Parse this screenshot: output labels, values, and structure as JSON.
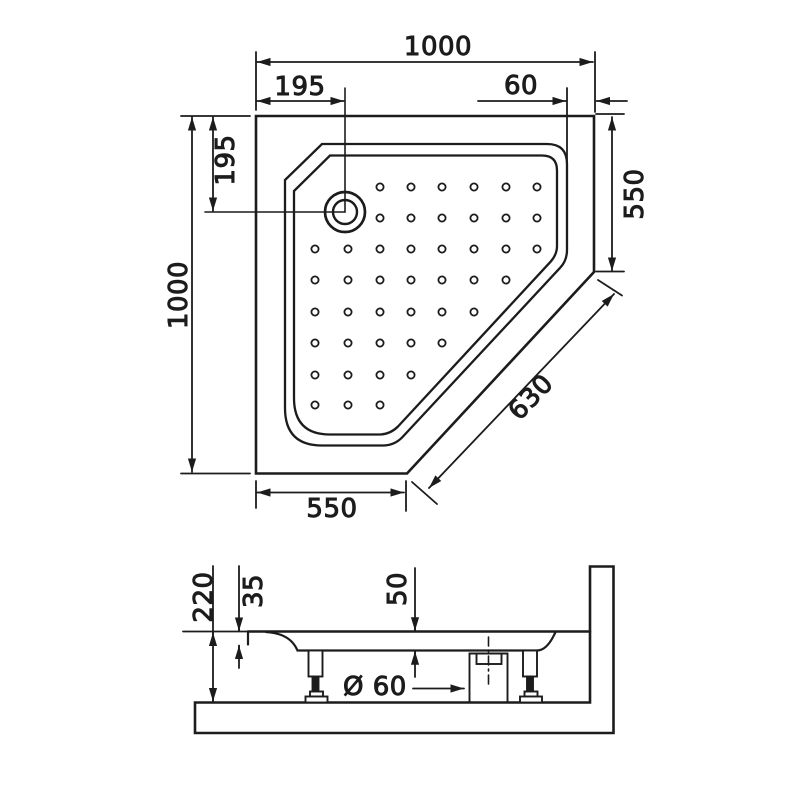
{
  "drawing": {
    "top_view": {
      "dim_overall_width": "1000",
      "dim_drain_from_left": "195",
      "dim_edge_offset": "60",
      "dim_overall_height": "1000",
      "dim_drain_from_top": "195",
      "dim_side_right": "550",
      "dim_diagonal_front": "630",
      "dim_side_bottom": "550"
    },
    "side_view": {
      "dim_total_height": "220",
      "dim_rim_thickness": "35",
      "dim_basin_depth": "50",
      "dim_drain_label": "Ø 60"
    }
  }
}
